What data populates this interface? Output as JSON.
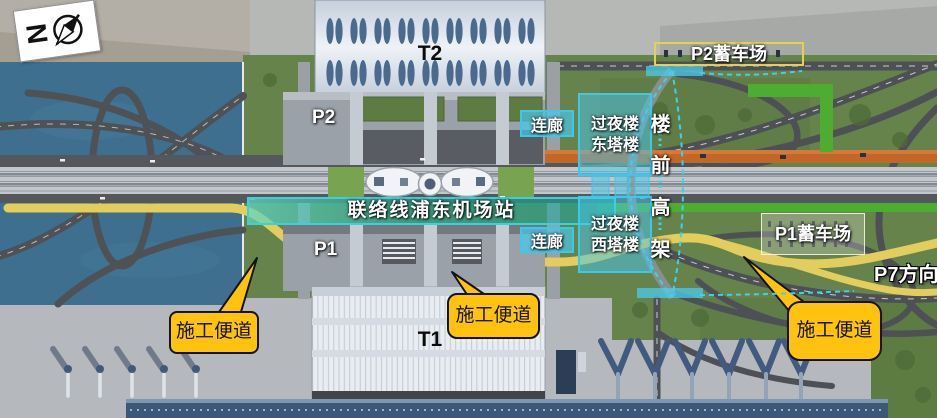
{
  "colors": {
    "annotation_cyan": "#3CC8EA",
    "station_teal": "#1EAFA0",
    "callout_yellow": "#FFC20E",
    "construction_road_yellow": "#E2CD5D",
    "p2_lot_border": "#E6D24A",
    "water_blue": "#3E6F8E"
  },
  "compass": {
    "north_letter": "N"
  },
  "labels": {
    "t2": "T2",
    "t1": "T1",
    "p2": "P2",
    "p1": "P1",
    "station": "联络线浦东机场站",
    "corridor_north": "连廊",
    "corridor_south": "连廊",
    "east_tower_line1": "过夜楼",
    "east_tower_line2": "东塔楼",
    "west_tower_line1": "过夜楼",
    "west_tower_line2": "西塔楼",
    "p2_lot": "P2蓄车场",
    "p1_lot": "P1蓄车场",
    "p7_direction": "P7方向"
  },
  "viaduct_chars": [
    "楼",
    "前",
    "高",
    "架"
  ],
  "callouts": [
    {
      "label": "施工便道"
    },
    {
      "label": "施工便道"
    },
    {
      "label": "施工便道"
    }
  ]
}
